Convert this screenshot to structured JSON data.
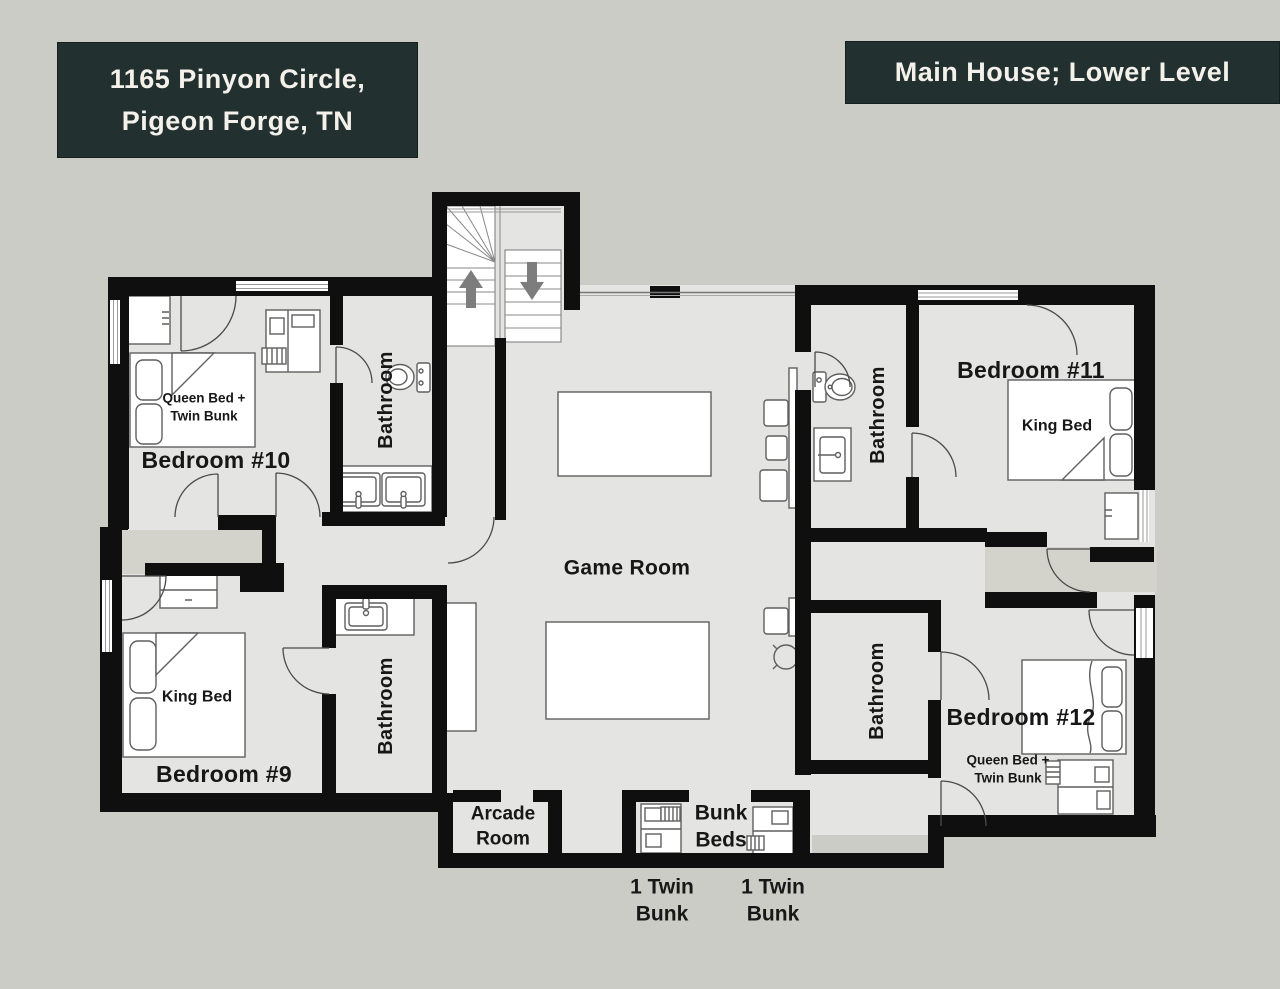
{
  "header": {
    "address_line1": "1165 Pinyon Circle,",
    "address_line2": "Pigeon Forge, TN",
    "level_title": "Main House; Lower Level"
  },
  "plan": {
    "bedroom_10": {
      "name": "Bedroom #10",
      "bed_line1": "Queen Bed +",
      "bed_line2": "Twin Bunk"
    },
    "bedroom_11": {
      "name": "Bedroom #11",
      "bed": "King Bed"
    },
    "bedroom_9": {
      "name": "Bedroom #9",
      "bed": "King Bed"
    },
    "bedroom_12": {
      "name": "Bedroom #12",
      "bed_line1": "Queen Bed +",
      "bed_line2": "Twin Bunk"
    },
    "game_room": {
      "name": "Game Room"
    },
    "arcade_room": {
      "name_line1": "Arcade",
      "name_line2": "Room"
    },
    "bunk_nook": {
      "name_line1": "Bunk",
      "name_line2": "Beds"
    },
    "bathrooms": {
      "top_left": "Bathroom",
      "top_right": "Bathroom",
      "bottom_left": "Bathroom",
      "bottom_right": "Bathroom"
    },
    "captions": {
      "bunk_left_line1": "1 Twin",
      "bunk_left_line2": "Bunk",
      "bunk_right_line1": "1 Twin",
      "bunk_right_line2": "Bunk"
    }
  },
  "icons": {
    "stairs_up": "up-arrow-icon",
    "stairs_down": "down-arrow-icon"
  },
  "colors": {
    "page_background": "#cbccc5",
    "floor": "#e4e4e2",
    "corridor_floor": "#d3d3cb",
    "walls": "#0f0f0f",
    "header_background": "#223030",
    "header_text": "#f4f1ea",
    "label_text": "#171717"
  }
}
